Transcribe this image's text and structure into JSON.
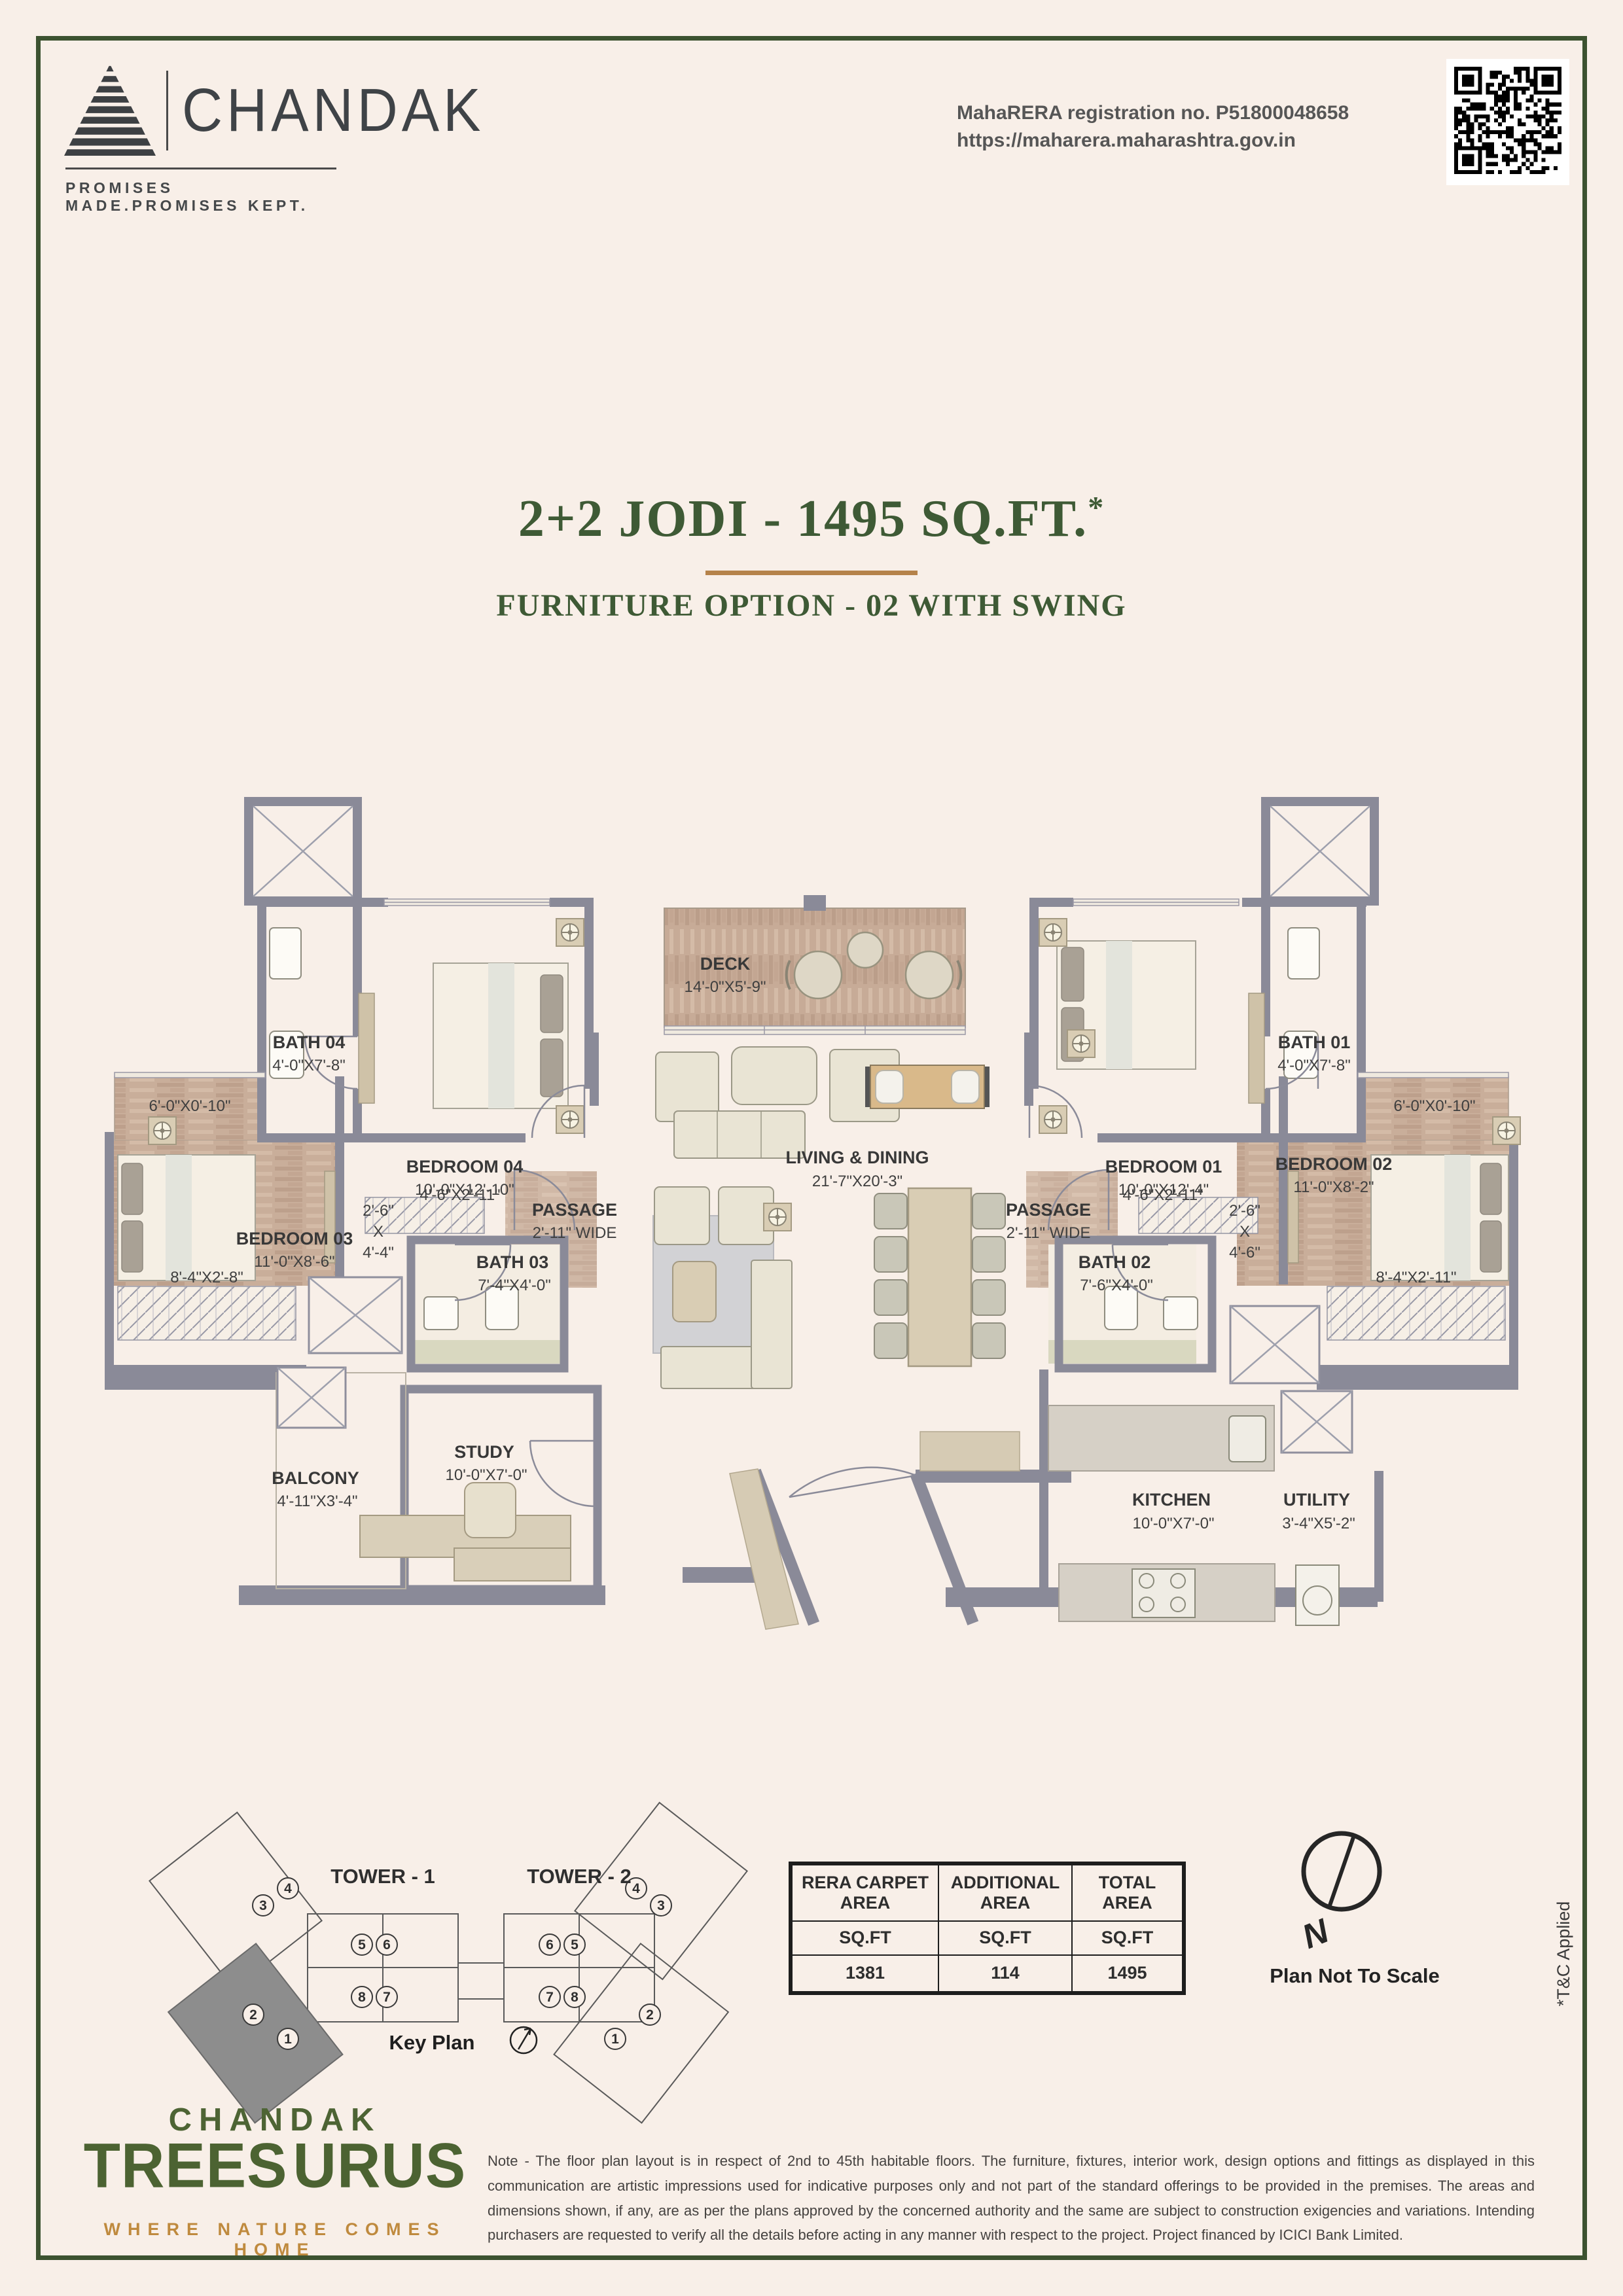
{
  "header": {
    "brand": "CHANDAK",
    "tagline": "PROMISES MADE.PROMISES KEPT.",
    "rera1": "MahaRERA registration no. P51800048658",
    "rera2": "https://maharera.maharashtra.gov.in"
  },
  "title": {
    "main": "2+2 JODI - 1495 SQ.FT.",
    "sup": "*",
    "subtitle": "FURNITURE OPTION - 02 WITH SWING"
  },
  "plan": {
    "rooms": [
      {
        "name": "BATH 04",
        "dims": "4'-0\"X7'-8\""
      },
      {
        "name": "BEDROOM 04",
        "dims": "10'-0\"X12'-10\""
      },
      {
        "name": "DECK",
        "dims": "14'-0\"X5'-9\""
      },
      {
        "name": "BEDROOM 01",
        "dims": "10'-0\"X12'-4\""
      },
      {
        "name": "BATH 01",
        "dims": "4'-0\"X7'-8\""
      },
      {
        "name": "BEDROOM 03",
        "dims": "11'-0\"X8'-6\""
      },
      {
        "name": "BEDROOM 02",
        "dims": "11'-0\"X8'-2\""
      },
      {
        "name": "LIVING & DINING",
        "dims": "21'-7\"X20'-3\""
      },
      {
        "name": "PASSAGE",
        "dims": "2'-11\" WIDE"
      },
      {
        "name": "PASSAGE",
        "dims": "2'-11\" WIDE"
      },
      {
        "name": "BATH 03",
        "dims": "7'-4\"X4'-0\""
      },
      {
        "name": "BATH 02",
        "dims": "7'-6\"X4'-0\""
      },
      {
        "name": "STUDY",
        "dims": "10'-0\"X7'-0\""
      },
      {
        "name": "BALCONY",
        "dims": "4'-11\"X3'-4\""
      },
      {
        "name": "KITCHEN",
        "dims": "10'-0\"X7'-0\""
      },
      {
        "name": "UTILITY",
        "dims": "3'-4\"X5'-2\""
      }
    ],
    "extra": {
      "balcony_l": "6'-0\"X0'-10\"",
      "balcony_r": "6'-0\"X0'-10\"",
      "ward_l": "8'-4\"X2'-8\"",
      "ward_r": "8'-4\"X2'-11\"",
      "pass_l": "4'-6\"X2'-11\"",
      "pass_r": "4'-6\"X2'-11\"",
      "niche_l": [
        "2'-6\"",
        "X",
        "4'-4\""
      ],
      "niche_r": [
        "2'-6\"",
        "X",
        "4'-6\""
      ]
    }
  },
  "keyplan": {
    "tower1": "TOWER - 1",
    "tower2": "TOWER - 2",
    "label": "Key Plan",
    "t1": {
      "tl": [
        "3",
        "4"
      ],
      "mt": [
        "5",
        "6"
      ],
      "mb": [
        "8",
        "7"
      ],
      "bl": [
        "2",
        "1"
      ]
    },
    "t2": {
      "mt": [
        "6",
        "5"
      ],
      "mb": [
        "7",
        "8"
      ],
      "tr": [
        "4",
        "3"
      ],
      "br": [
        "1",
        "2"
      ]
    }
  },
  "table": {
    "col1": {
      "l1": "RERA CARPET",
      "l2": "AREA"
    },
    "col2": {
      "l1": "ADDITIONAL",
      "l2": "AREA"
    },
    "col3": {
      "l1": "TOTAL",
      "l2": "AREA"
    },
    "unit": "SQ.FT",
    "values": [
      "1381",
      "114",
      "1495"
    ]
  },
  "compass": {
    "n": "N"
  },
  "misc": {
    "not_to_scale": "Plan Not To Scale",
    "tnc": "*T&C Applied"
  },
  "footer": {
    "brand": "CHANDAK",
    "name_a": "TREES",
    "name_b": "URUS",
    "tagline": "WHERE NATURE COMES HOME",
    "note": "Note - The floor plan layout is in respect of 2nd to 45th habitable floors. The furniture, fixtures, interior work, design options and fittings as displayed in this communication are artistic impressions used for indicative purposes only and not part of the standard offerings to be provided in the premises. The areas and dimensions shown, if any, are as per the plans approved by the concerned authority and the same are subject to construction exigencies and variations. Intending purchasers are requested to verify all the details before acting in any manner with respect to the project. Project financed by ICICI Bank Limited."
  }
}
